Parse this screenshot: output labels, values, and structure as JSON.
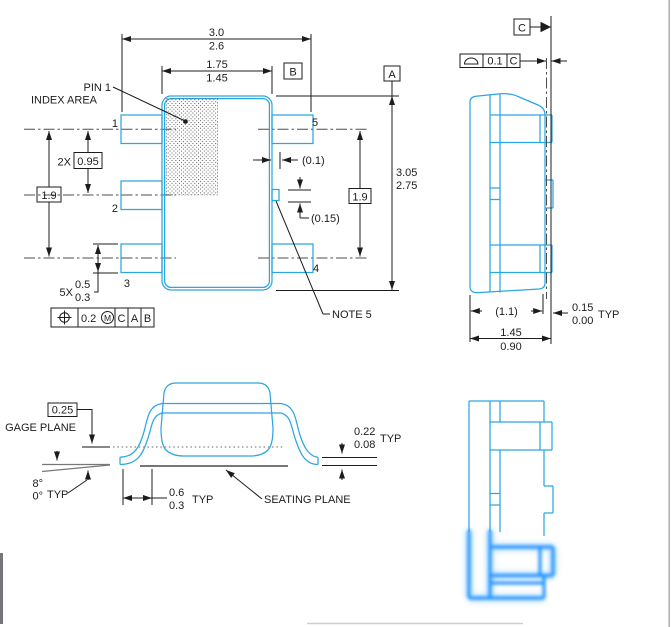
{
  "top": {
    "pin1_line1": "PIN 1",
    "pin1_line2": "INDEX AREA",
    "dim_overall_upper": "3.0",
    "dim_overall_lower": "2.6",
    "dim_body_upper": "1.75",
    "dim_body_lower": "1.45",
    "datum_a": "A",
    "datum_b": "B",
    "pin_1": "1",
    "pin_2": "2",
    "pin_3": "3",
    "pin_4": "4",
    "pin_5": "5",
    "pitch_prefix": "2X",
    "pitch_value": "0.95",
    "span_left": "1.9",
    "span_right": "1.9",
    "dim_len_upper": "3.05",
    "dim_len_lower": "2.75",
    "gap1": "(0.1)",
    "gap2": "(0.15)",
    "lead_prefix": "5X",
    "lead_upper": "0.5",
    "lead_lower": "0.3",
    "note": "NOTE 5",
    "fcf_tol": "0.2",
    "fcf_mod": "M",
    "fcf_d1": "C",
    "fcf_d2": "A",
    "fcf_d3": "B"
  },
  "side": {
    "datum_c": "C",
    "prof_tol": "0.1",
    "prof_datum": "C",
    "dim_ref": "(1.1)",
    "standoff_upper": "0.15",
    "standoff_lower": "0.00",
    "standoff_typ": "TYP",
    "width_upper": "1.45",
    "width_lower": "0.90"
  },
  "front": {
    "gage_value": "0.25",
    "gage_label": "GAGE PLANE",
    "angle_upper": "8°",
    "angle_lower": "0°",
    "angle_typ": "TYP",
    "thick_upper": "0.22",
    "thick_lower": "0.08",
    "thick_typ": "TYP",
    "foot_upper": "0.6",
    "foot_lower": "0.3",
    "foot_typ": "TYP",
    "seating_label": "SEATING PLANE"
  },
  "colors": {
    "line_blue": "#2ca6df",
    "highlight_blue": "#1f8fff",
    "dimension_black": "#1c1c1e"
  }
}
